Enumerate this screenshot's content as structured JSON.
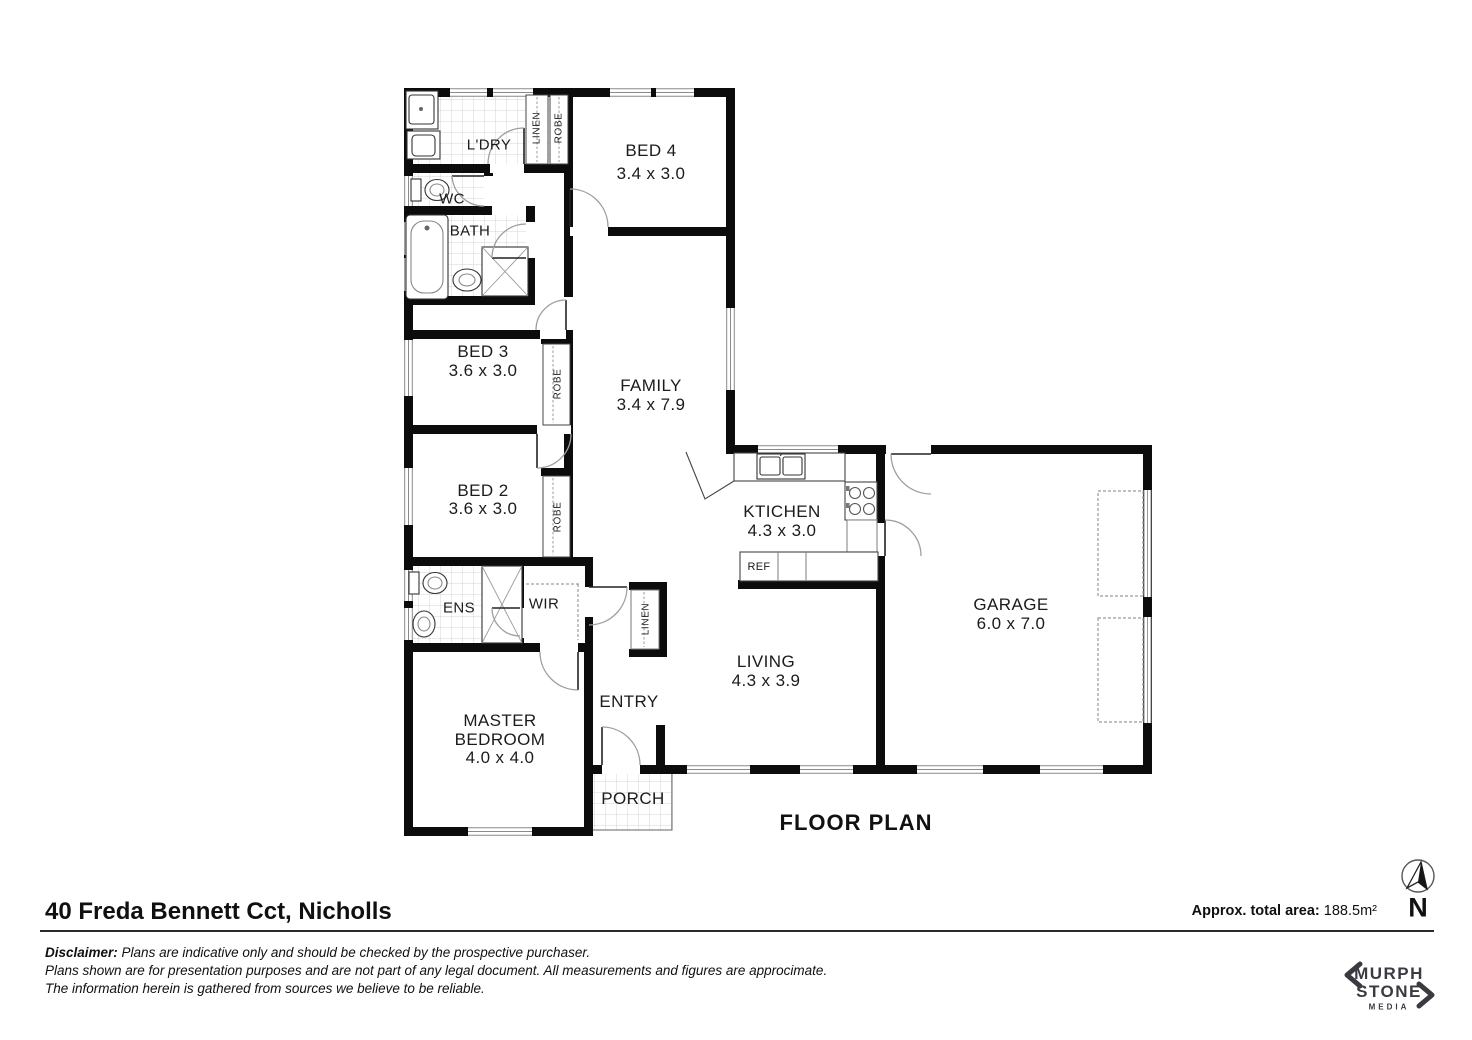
{
  "plan": {
    "title": "FLOOR PLAN",
    "rooms": {
      "ldry": {
        "label": "L'DRY"
      },
      "bed4": {
        "label": "BED 4",
        "dims": "3.4 x 3.0"
      },
      "wc": {
        "label": "WC"
      },
      "bath": {
        "label": "BATH"
      },
      "bed3": {
        "label": "BED 3",
        "dims": "3.6 x 3.0"
      },
      "family": {
        "label": "FAMILY",
        "dims": "3.4 x 7.9"
      },
      "bed2": {
        "label": "BED 2",
        "dims": "3.6 x 3.0"
      },
      "kitchen": {
        "label": "KTICHEN",
        "dims": "4.3 x 3.0"
      },
      "garage": {
        "label": "GARAGE",
        "dims": "6.0 x 7.0"
      },
      "ens": {
        "label": "ENS"
      },
      "wir": {
        "label": "WIR"
      },
      "living": {
        "label": "LIVING",
        "dims": "4.3 x 3.9"
      },
      "entry": {
        "label": "ENTRY"
      },
      "master": {
        "label_line1": "MASTER",
        "label_line2": "BEDROOM",
        "dims": "4.0 x 4.0"
      },
      "porch": {
        "label": "PORCH"
      }
    },
    "closets": {
      "robe": "ROBE",
      "linen": "LINEN"
    },
    "appliances": {
      "fridge": "REF"
    }
  },
  "footer": {
    "address": "40 Freda Bennett Cct, Nicholls",
    "area_label": "Approx. total area:",
    "area_value": "188.5m²",
    "north_letter": "N",
    "disclaimer_lines": [
      {
        "bold": "Disclaimer:",
        "text": " Plans are indicative only and should be checked by the prospective purchaser."
      },
      {
        "bold": "",
        "text": "Plans shown are for presentation purposes and are not part of any legal document. All measurements and figures are approcimate."
      },
      {
        "bold": "",
        "text": "The information herein is gathered from sources we believe to be reliable."
      }
    ],
    "logo": {
      "word1": "MURPH",
      "word2": "STONE",
      "word3": "MEDIA"
    }
  }
}
